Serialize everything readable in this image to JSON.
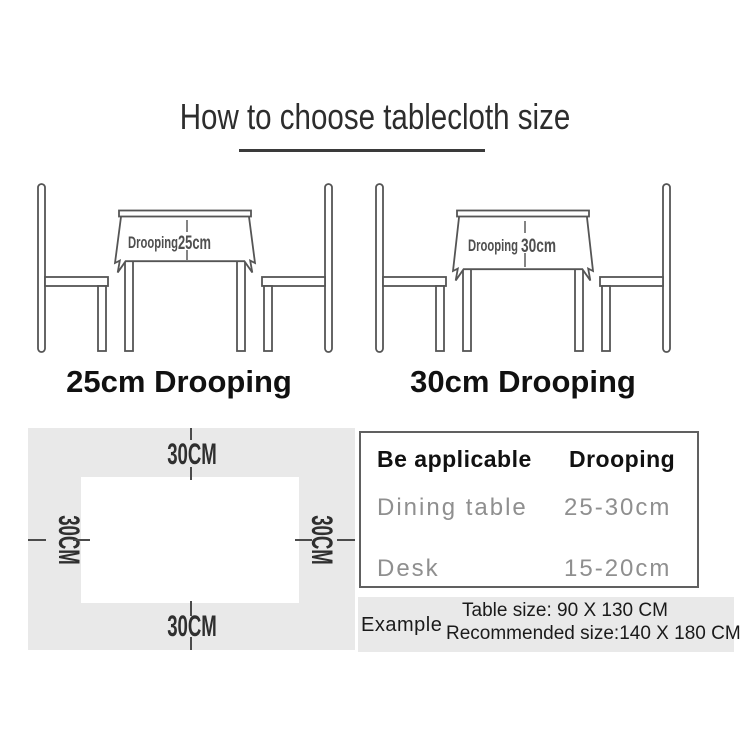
{
  "title": "How to choose tablecloth size",
  "diagrams": {
    "left": {
      "annotation": "Drooping",
      "value": "25cm",
      "caption": "25cm Drooping"
    },
    "right": {
      "annotation": "Drooping",
      "value": "30cm",
      "caption": "30cm Drooping"
    }
  },
  "margin_diagram": {
    "top_label": "30CM",
    "bottom_label": "30CM",
    "left_label": "30CM",
    "right_label": "30CM"
  },
  "spec_table": {
    "col1_header": "Be applicable",
    "col2_header": "Drooping",
    "rows": [
      {
        "name": "Dining table",
        "value": "25-30cm"
      },
      {
        "name": "Desk",
        "value": "15-20cm"
      }
    ]
  },
  "example": {
    "label": "Example",
    "table_size_line": "Table size:  90 X 130 CM",
    "recommended_line": "Recommended size:140 X 180 CM"
  },
  "colors": {
    "line": "#555555",
    "panel_gray": "#e9e9e9",
    "muted_text": "#8f8f8f",
    "ink": "#1a1a1a"
  }
}
